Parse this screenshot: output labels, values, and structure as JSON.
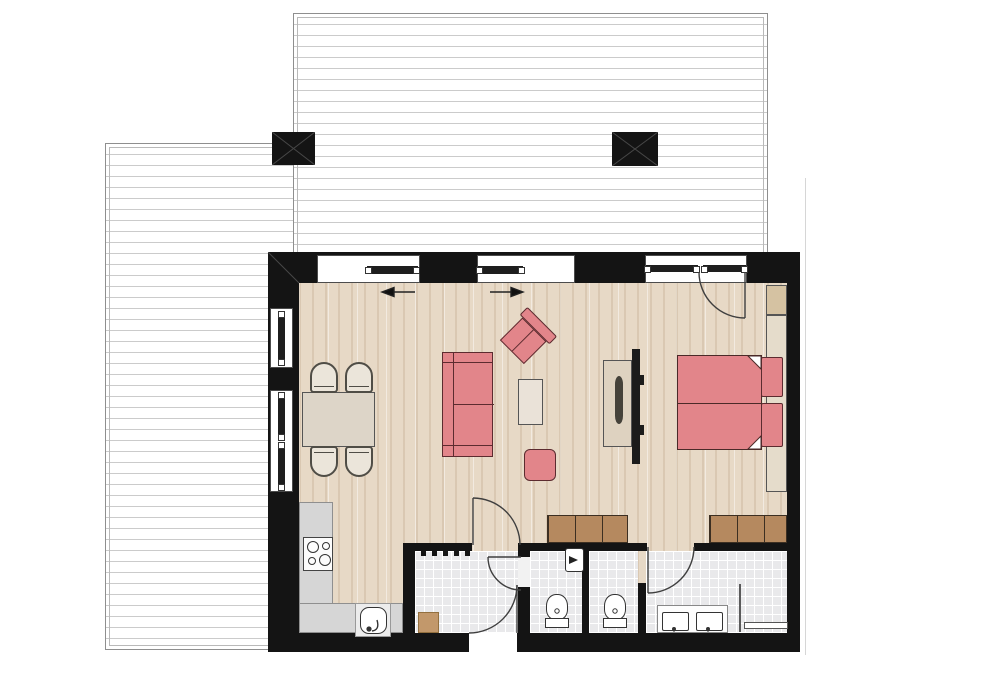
{
  "title": "apartment-floor-plan",
  "colors": {
    "wall": "#141414",
    "wood_floor": "#e7d9c6",
    "tile_floor": "#e9e9eb",
    "deck_stripe": "#cbcbcb",
    "upholstery_red": "#e2858a",
    "upholstery_outline": "#5c2b2f",
    "wardrobe_wood": "#b5895f",
    "counter_gray": "#d6d6d6",
    "furniture_beige": "#ddd5c8",
    "window_white": "#ffffff"
  },
  "rooms": [
    {
      "name": "living-dining-area",
      "floor": "wood"
    },
    {
      "name": "bedroom-area",
      "floor": "wood"
    },
    {
      "name": "kitchen",
      "floor": "wood"
    },
    {
      "name": "entry-hallway",
      "floor": "tile"
    },
    {
      "name": "guest-wc",
      "floor": "tile"
    },
    {
      "name": "toilet-nook",
      "floor": "tile"
    },
    {
      "name": "bathroom",
      "floor": "tile"
    },
    {
      "name": "terrace-top",
      "floor": "deck-boards"
    },
    {
      "name": "terrace-left",
      "floor": "deck-boards"
    }
  ],
  "fixtures": [
    "sofa",
    "armchair",
    "coffee-table",
    "pouf",
    "dining-table",
    "four-chairs",
    "double-bed",
    "two-pillows",
    "headboard",
    "tv",
    "tv-cabinet",
    "wardrobe-left",
    "wardrobe-right",
    "kitchen-counter",
    "stove",
    "kitchen-sink",
    "wc-sink",
    "toilet-1",
    "toilet-2",
    "double-vanity",
    "shower-screen",
    "towel-bar",
    "door-mat",
    "radiator",
    "two-columns"
  ],
  "doors": [
    {
      "name": "bedroom-terrace-door",
      "swing": "in"
    },
    {
      "name": "living-hall-door",
      "swing": "into-living"
    },
    {
      "name": "guest-wc-door",
      "swing": "into-wc"
    },
    {
      "name": "entrance-door",
      "swing": "into-hall"
    },
    {
      "name": "bathroom-door",
      "swing": "into-bath"
    }
  ],
  "sliding_panels": {
    "left_arrow": "slides-left",
    "right_arrow": "slides-right"
  },
  "plan": {
    "items": [
      {
        "kind": "dining-table",
        "name": "dining-table",
        "x": 302,
        "y": 392,
        "w": 73,
        "h": 55
      },
      {
        "kind": "chair chair-top",
        "name": "dining-chair",
        "x": 310,
        "y": 362,
        "w": 28,
        "h": 31
      },
      {
        "kind": "chair chair-top",
        "name": "dining-chair",
        "x": 345,
        "y": 362,
        "w": 28,
        "h": 31
      },
      {
        "kind": "chair chair-bottom",
        "name": "dining-chair",
        "x": 310,
        "y": 446,
        "w": 28,
        "h": 31
      },
      {
        "kind": "chair chair-bottom",
        "name": "dining-chair",
        "x": 345,
        "y": 446,
        "w": 28,
        "h": 31
      },
      {
        "kind": "coffee-table",
        "name": "coffee-table",
        "x": 518,
        "y": 379,
        "w": 25,
        "h": 46
      },
      {
        "kind": "pouf",
        "name": "pouf",
        "x": 524,
        "y": 449,
        "w": 32,
        "h": 32
      },
      {
        "kind": "tv-cabinet",
        "name": "tv-cabinet",
        "x": 603,
        "y": 360,
        "w": 29,
        "h": 87
      },
      {
        "kind": "tv",
        "name": "tv",
        "x": 632,
        "y": 349,
        "w": 8,
        "h": 115
      },
      {
        "kind": "tv-bump",
        "name": "tv-mount",
        "x": 640,
        "y": 375,
        "w": 4,
        "h": 10
      },
      {
        "kind": "tv-bump",
        "name": "tv-mount",
        "x": 640,
        "y": 425,
        "w": 4,
        "h": 10
      },
      {
        "kind": "corner-cabinet",
        "name": "bedside-cabinet",
        "x": 766,
        "y": 285,
        "w": 21,
        "h": 30
      },
      {
        "kind": "headboard",
        "name": "bed-headboard",
        "x": 766,
        "y": 315,
        "w": 21,
        "h": 177
      },
      {
        "kind": "wardrobe",
        "name": "wardrobe-left",
        "x": 547,
        "y": 515,
        "w": 81,
        "h": 28
      },
      {
        "kind": "wardrobe",
        "name": "wardrobe-right",
        "x": 709,
        "y": 515,
        "w": 78,
        "h": 28
      },
      {
        "kind": "counter",
        "name": "kitchen-counter-left",
        "x": 299,
        "y": 502,
        "w": 34,
        "h": 131
      },
      {
        "kind": "counter",
        "name": "kitchen-counter-bottom",
        "x": 299,
        "y": 603,
        "w": 104,
        "h": 30
      },
      {
        "kind": "towel-bar",
        "name": "towel-bar",
        "x": 744,
        "y": 622,
        "w": 44,
        "h": 7
      },
      {
        "kind": "mat",
        "name": "door-mat",
        "x": 418,
        "y": 612,
        "w": 21,
        "h": 21
      },
      {
        "kind": "tick",
        "name": "radiator-tick",
        "x": 421,
        "y": 551,
        "w": 5,
        "h": 5
      },
      {
        "kind": "tick",
        "name": "radiator-tick",
        "x": 432,
        "y": 551,
        "w": 5,
        "h": 5
      },
      {
        "kind": "tick",
        "name": "radiator-tick",
        "x": 443,
        "y": 551,
        "w": 5,
        "h": 5
      },
      {
        "kind": "tick",
        "name": "radiator-tick",
        "x": 454,
        "y": 551,
        "w": 5,
        "h": 5
      },
      {
        "kind": "tick",
        "name": "radiator-tick",
        "x": 465,
        "y": 551,
        "w": 5,
        "h": 5
      }
    ]
  }
}
